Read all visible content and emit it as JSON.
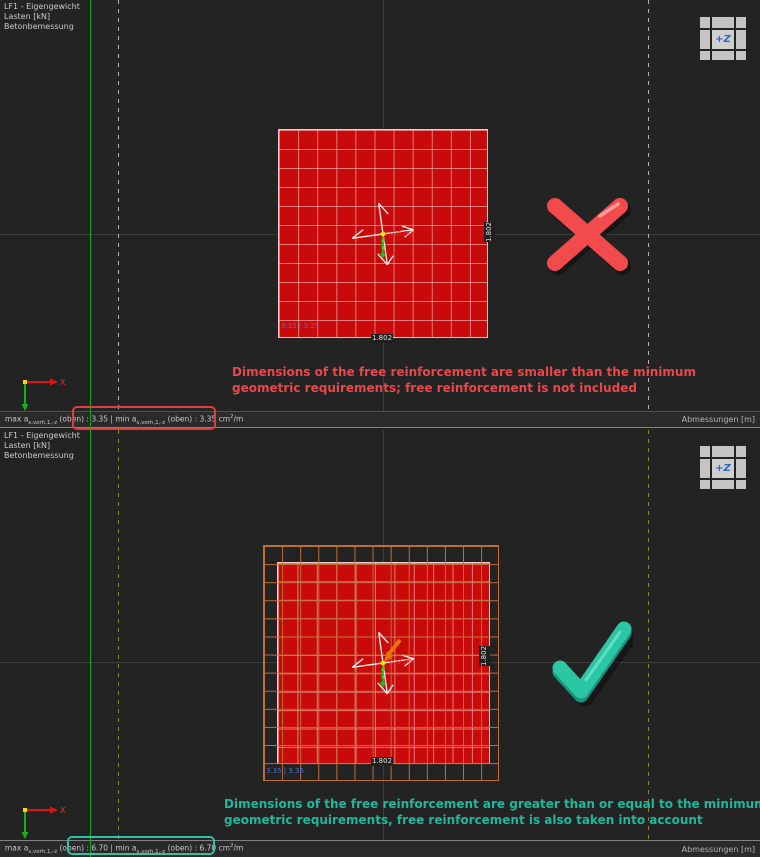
{
  "panels": [
    {
      "info": [
        "LF1 - Eigengewicht",
        "Lasten [kN]",
        "Betonbemessung"
      ],
      "viewcube_label": "+Z",
      "axes_x": "X",
      "center_label": "100.00",
      "corner_label": "3.35 | 3.35",
      "dim_width": "1.802",
      "dim_height": "1.802",
      "message": {
        "line1": "Dimensions of the free reinforcement are smaller than the minimum",
        "line2": "geometric requirements; free reinforcement is not included"
      },
      "status": {
        "max_prefix": "max a",
        "sub": "s,vorh,1,-z",
        "mid": " (oben) : ",
        "max_value": "3.35",
        "min_prefix": " | min a",
        "min_value": "3.35",
        "unit_base": " cm",
        "unit_exp": "2",
        "unit_rest": "/m",
        "right_label": "Abmessungen [m]"
      },
      "result_mark": "cross"
    },
    {
      "info": [
        "LF1 - Eigengewicht",
        "Lasten [kN]",
        "Betonbemessung"
      ],
      "viewcube_label": "+Z",
      "axes_x": "X",
      "center_label": "100.00",
      "corner_label": "3.35 | 3.35",
      "dim_width": "1.802",
      "dim_height": "1.802",
      "message": {
        "line1": "Dimensions of the free reinforcement are greater than or equal to the minimum",
        "line2": "geometric requirements, free reinforcement is also taken into account"
      },
      "status": {
        "max_prefix": "max a",
        "sub": "s,vorh,1,-z",
        "mid": " (oben) : ",
        "max_value": "6.70",
        "min_prefix": " | min a",
        "min_value": "6.70",
        "unit_base": " cm",
        "unit_exp": "2",
        "unit_rest": "/m",
        "right_label": "Abmessungen [m]"
      },
      "result_mark": "check"
    }
  ],
  "colors": {
    "reinforcement_fill": "#c80a0a",
    "mesh_orange": "#bf6f38",
    "grid_line_green": "#12a42c",
    "annotation_red": "#e8484b",
    "annotation_teal": "#1fb89c",
    "value_label_blue": "#4a6fd4"
  }
}
